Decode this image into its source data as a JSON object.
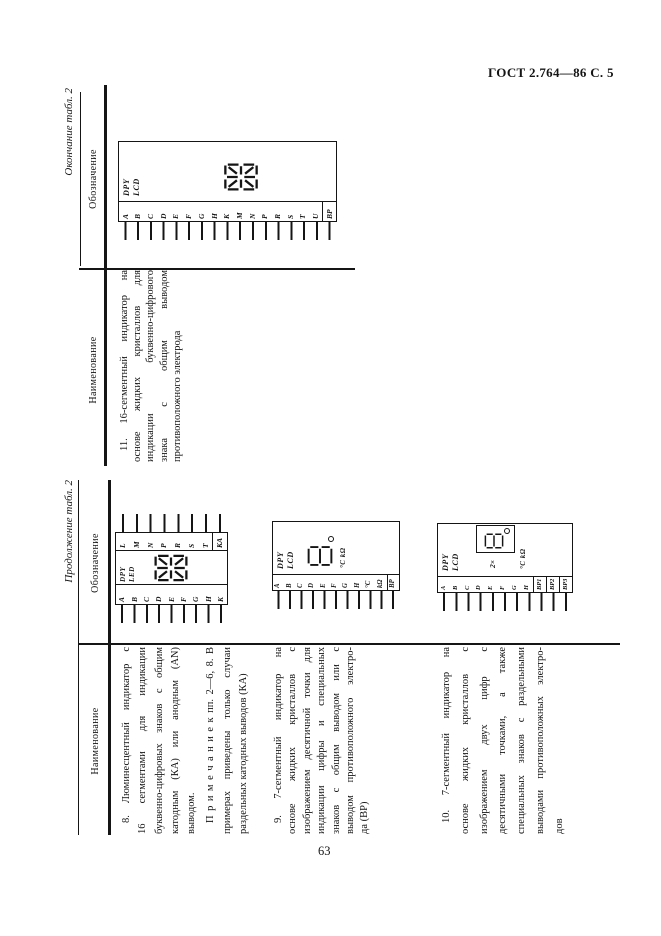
{
  "page": {
    "header": "ГОСТ 2.764—86 С. 5",
    "number": "63"
  },
  "top_table": {
    "title": "Окончание табл. 2",
    "col_name": "Наименование",
    "col_sym": "Обозначение",
    "item11": {
      "lines": [
        "11. 16-сегментный индикатор на",
        "основе жидких кристаллов для",
        "индикации буквенно-цифрового",
        "знака с общим выводом",
        "противоположного электрода"
      ]
    }
  },
  "bottom_table": {
    "title": "Продолжение табл. 2",
    "col_name": "Наименование",
    "col_sym": "Обозначение",
    "item8": {
      "lines": [
        "8. Люминесцентный индикатор с",
        "16 сегментами для индикации",
        "буквенно-цифровых знаков с общим",
        "катодным (КА) или анодным (AN)",
        "выводом."
      ],
      "note": [
        "П р и м е ч а н и е  к пп. 2—6, 8. В",
        "примерах приведены только случаи",
        "раздельных катодных выводов (КА)"
      ]
    },
    "item9": {
      "lines": [
        "9. 7-сегментный индикатор на",
        "основе жидких кристаллов с",
        "изображением десятичной точки для",
        "индикации цифры и специальных",
        "знаков с общим выводом или с",
        "выводом противоположного электро-",
        "да (BP)"
      ]
    },
    "item10": {
      "lines": [
        "10. 7-сегментный индикатор на",
        "основе жидких кристаллов с",
        "изображением двух цифр с",
        "десятичными точками, а также",
        "специальных знаков с раздельными",
        "выводами противоположных электро-",
        "дов"
      ]
    }
  },
  "diagrams": {
    "d11": {
      "dev": "DPY",
      "tech": "LCD",
      "pins": [
        "A",
        "B",
        "C",
        "D",
        "E",
        "F",
        "G",
        "H",
        "K",
        "M",
        "N",
        "P",
        "R",
        "S",
        "T",
        "U"
      ],
      "common": "BP"
    },
    "d8": {
      "dev": "DPY",
      "tech": "LED",
      "pins_left": [
        "A",
        "B",
        "C",
        "D",
        "E",
        "F",
        "G",
        "H",
        "K"
      ],
      "pins_right": [
        "L",
        "M",
        "N",
        "P",
        "R",
        "S",
        "T"
      ],
      "common": "КА"
    },
    "d9": {
      "dev": "DPY",
      "tech": "LCD",
      "pins": [
        "A",
        "B",
        "C",
        "D",
        "E",
        "F",
        "G",
        "H",
        "°C",
        "kΩ"
      ],
      "common": "BP",
      "signs": "°C kΩ"
    },
    "d10": {
      "dev": "DPY",
      "tech": "LCD",
      "pins": [
        "A",
        "B",
        "C",
        "D",
        "E",
        "F",
        "G",
        "H"
      ],
      "commons": [
        "BP1",
        "BP2",
        "BP3"
      ],
      "signs": "°C kΩ",
      "multiplier": "2×"
    }
  }
}
